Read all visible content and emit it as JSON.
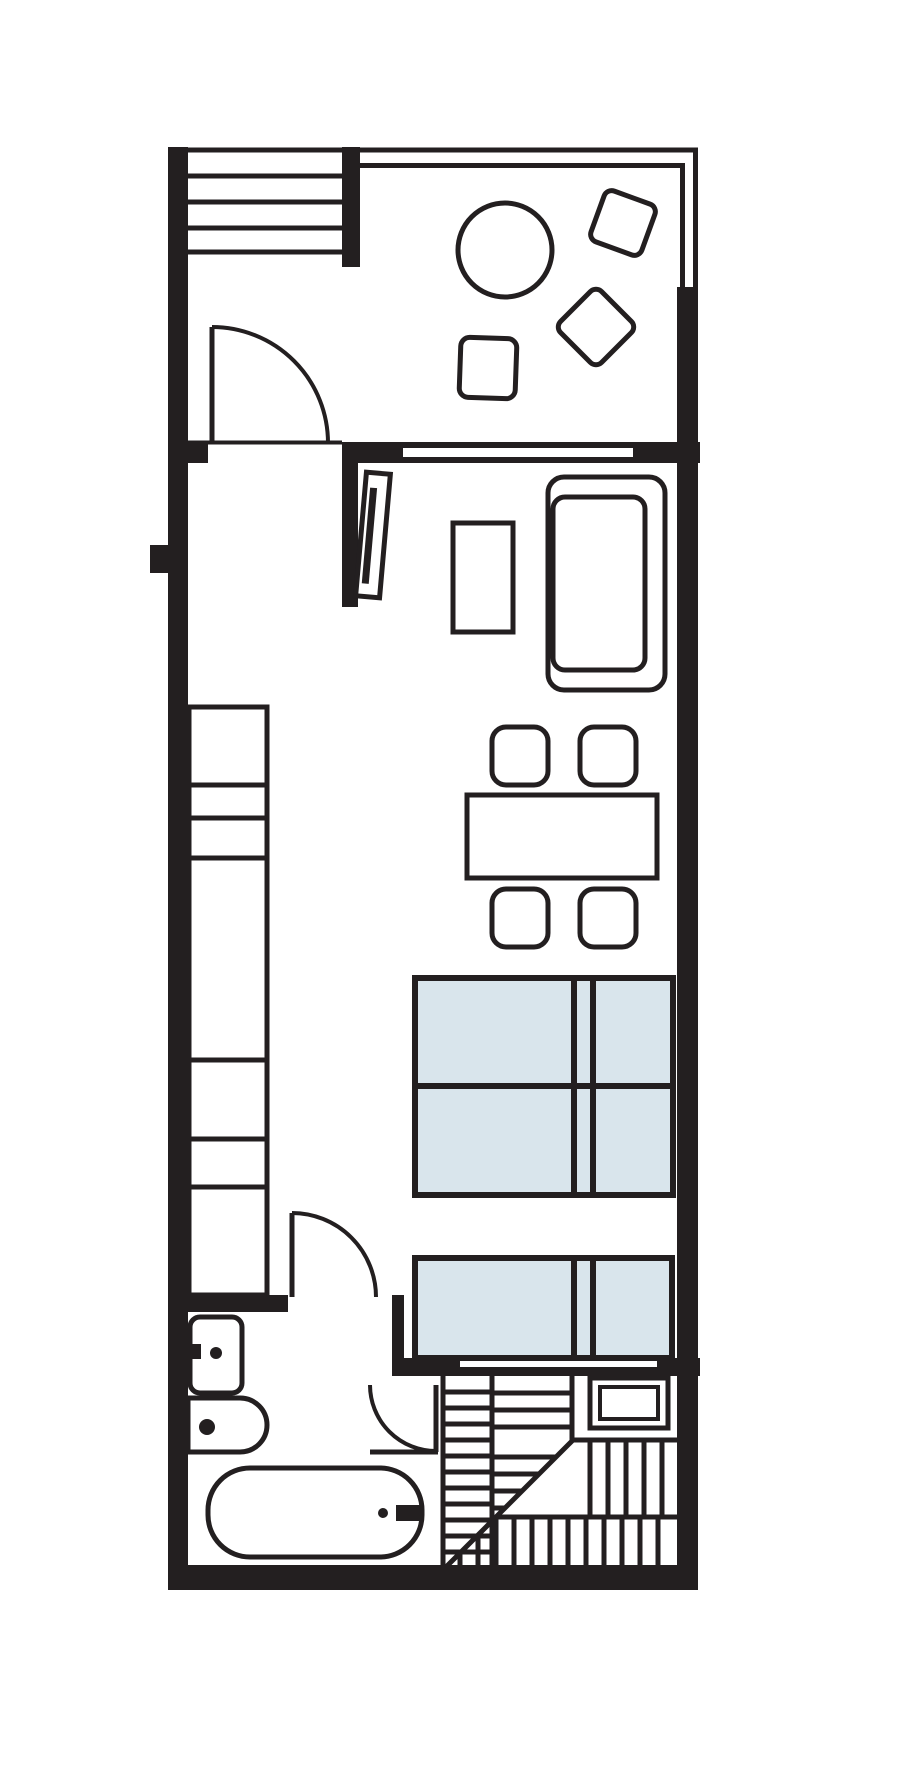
{
  "title": "Studio apartment floor plan",
  "colors": {
    "line": "#231f20",
    "wall": "#231f20",
    "bed_fill": "#d9e5ec",
    "background": "#ffffff"
  },
  "inventory": {
    "balcony": [
      "balcony-railing-wall",
      "round-patio-table",
      "patio-chair-upper",
      "patio-chair-lower",
      "patio-chair-left"
    ],
    "entry": [
      "entry-landing-steps",
      "entry-door"
    ],
    "living_area": [
      "window-to-balcony",
      "wall-mounted-tv",
      "side-table",
      "sofa",
      "dining-table",
      "dining-chair-1",
      "dining-chair-2",
      "dining-chair-3",
      "dining-chair-4"
    ],
    "sleeping_area": [
      "double-bed-with-pillows",
      "single-bed-with-pillow"
    ],
    "kitchen": [
      "counter-run-7-segments"
    ],
    "bathroom": [
      "bathroom-door",
      "wash-basin",
      "basin-tap",
      "toilet",
      "bathtub",
      "bathtub-tap"
    ],
    "stairs": [
      "stair-door",
      "winder-staircase",
      "floor-hatch"
    ]
  }
}
